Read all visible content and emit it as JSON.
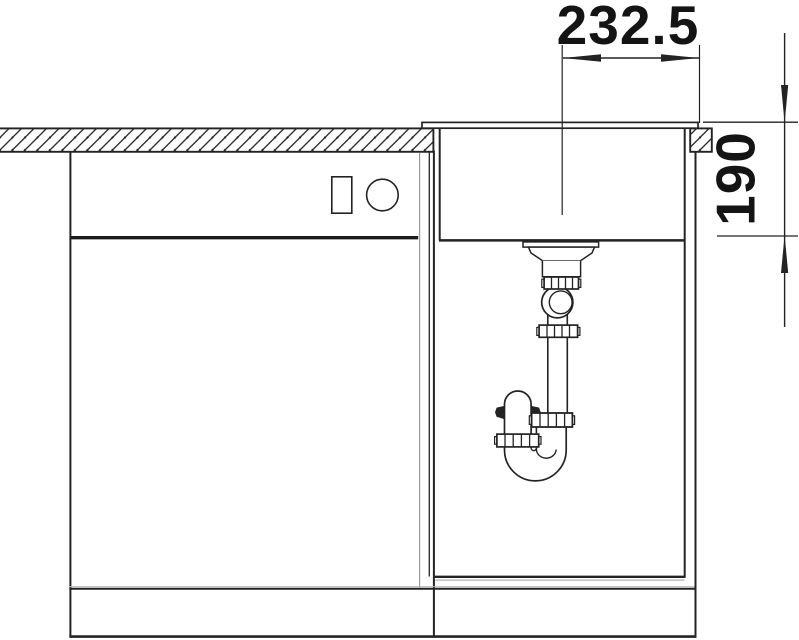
{
  "drawing": {
    "dimension_width_label": "232.5",
    "dimension_depth_label": "190"
  },
  "colors": {
    "line": "#232323",
    "background": "#ffffff",
    "shadow_gray": "#9a9a9a"
  }
}
